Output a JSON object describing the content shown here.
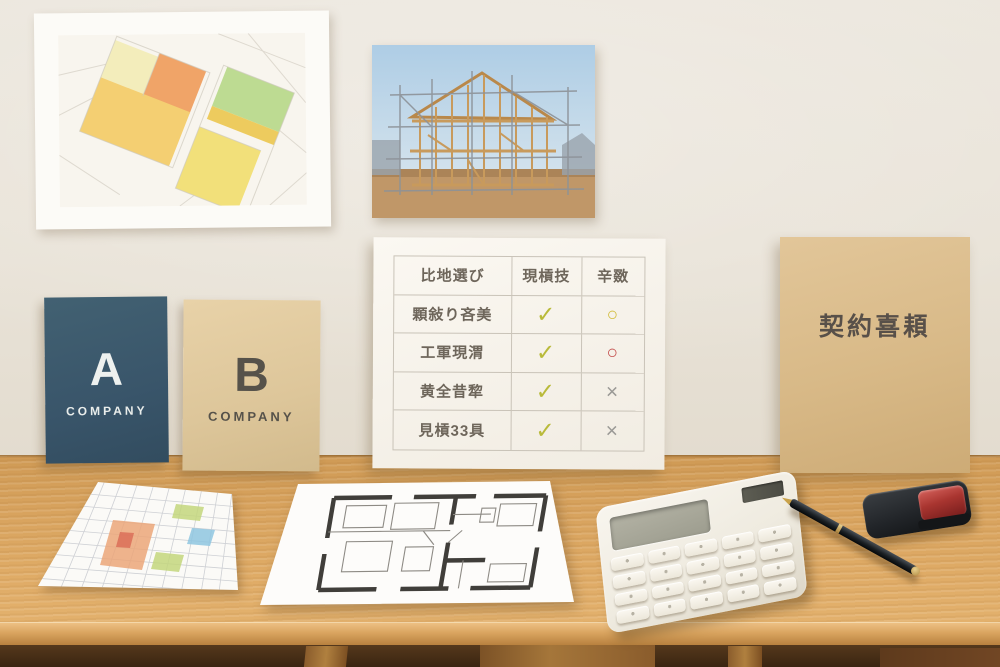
{
  "scene_title": "home-building consultation desk",
  "wall": {
    "color": "#eae4da"
  },
  "desk": {
    "surface_color": "#d7a25d",
    "edge_color": "#e0ad67",
    "under_color": "#3a2511"
  },
  "map_poster": {
    "background": "#f8f5ee",
    "parcel_colors": {
      "pale_yellow": "#f3edbb",
      "orange": "#f0a468",
      "amber": "#f4cf72",
      "green": "#bddb92",
      "yellow": "#f2e07a",
      "street": "#d8d3c8"
    }
  },
  "construction_photo": {
    "sky": "#bcd7ea",
    "wood": "#c89a5c",
    "ground": "#c09768",
    "scaffold": "#9aa0a6"
  },
  "comparison_board": {
    "headers": [
      "比地選び",
      "現槓技",
      "辛敪"
    ],
    "rows": [
      {
        "label": "顆敍り吝美",
        "col1": {
          "glyph": "✓",
          "type": "check"
        },
        "col2": {
          "glyph": "○",
          "type": "circle-yellow"
        }
      },
      {
        "label": "工軍現渭",
        "col1": {
          "glyph": "✓",
          "type": "check"
        },
        "col2": {
          "glyph": "○",
          "type": "circle-red"
        }
      },
      {
        "label": "黄全昔犂",
        "col1": {
          "glyph": "✓",
          "type": "check"
        },
        "col2": {
          "glyph": "×",
          "type": "cross"
        }
      },
      {
        "label": "見槓33具",
        "col1": {
          "glyph": "✓",
          "type": "check"
        },
        "col2": {
          "glyph": "×",
          "type": "cross"
        }
      }
    ],
    "mark_colors": {
      "check": "#b9ba3a",
      "circle_yellow": "#d3bd3e",
      "circle_red": "#c4504e",
      "cross": "#9b9a96"
    }
  },
  "contract_folder": {
    "title": "契約喜頛",
    "color": "#d8b987",
    "text_color": "#585049"
  },
  "booklet_a": {
    "letter": "A",
    "label": "COMPANY",
    "color": "#3a556a",
    "text_color": "#eef1ef"
  },
  "booklet_b": {
    "letter": "B",
    "label": "COMPANY",
    "color": "#ddc69a",
    "text_color": "#56524a"
  },
  "site_plan": {
    "colors": {
      "grid": "#b6bac2",
      "orange": "#eba679",
      "red": "#d96a55",
      "green": "#c3d67c",
      "blue": "#8ec6e0"
    }
  },
  "floor_plan": {
    "colors": {
      "wall": "#403e3a",
      "line": "#8d8a84",
      "paper": "#fdfcfa"
    }
  },
  "calculator": {
    "body": "#f1ede4",
    "display": "#a8a89a",
    "solar": "#52524a"
  },
  "pen": {
    "body": "#1b2024",
    "accent": "#c9a24a"
  },
  "stamp_case": {
    "body": "#212428",
    "lid": "#a93530"
  }
}
